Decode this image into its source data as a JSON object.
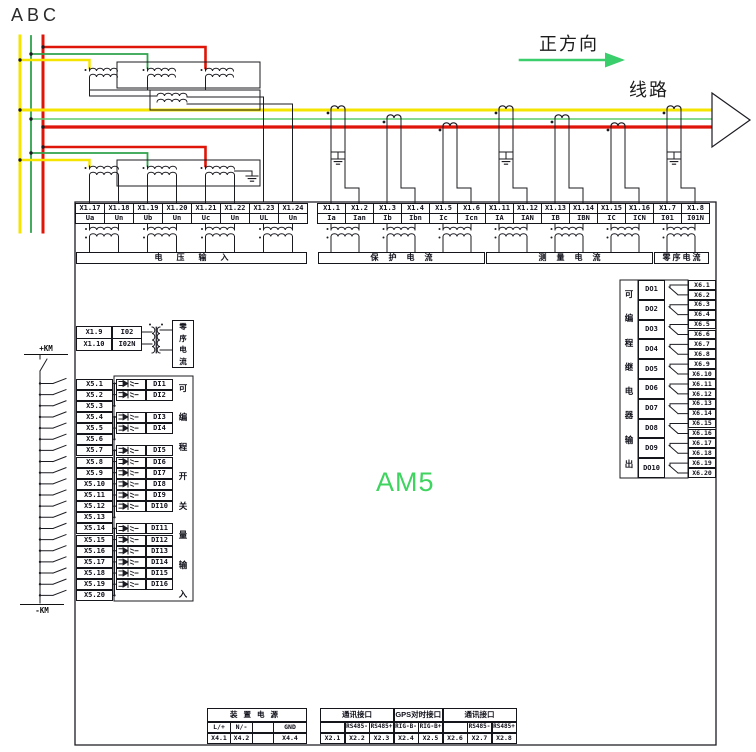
{
  "phases": [
    "A",
    "B",
    "C"
  ],
  "direction_label": "正方向",
  "line_label": "线路",
  "device_label": "AM5",
  "km_plus": "+KM",
  "km_minus": "-KM",
  "terminal_groups": [
    {
      "label": "电压输入",
      "terminals": [
        {
          "num": "X1.17",
          "name": "Ua"
        },
        {
          "num": "X1.18",
          "name": "Un"
        },
        {
          "num": "X1.19",
          "name": "Ub"
        },
        {
          "num": "X1.20",
          "name": "Un"
        },
        {
          "num": "X1.21",
          "name": "Uc"
        },
        {
          "num": "X1.22",
          "name": "Un"
        },
        {
          "num": "X1.23",
          "name": "UL"
        },
        {
          "num": "X1.24",
          "name": "Un"
        }
      ]
    },
    {
      "label": "保护电流",
      "terminals": [
        {
          "num": "X1.1",
          "name": "Ia"
        },
        {
          "num": "X1.2",
          "name": "Ian"
        },
        {
          "num": "X1.3",
          "name": "Ib"
        },
        {
          "num": "X1.4",
          "name": "Ibn"
        },
        {
          "num": "X1.5",
          "name": "Ic"
        },
        {
          "num": "X1.6",
          "name": "Icn"
        }
      ]
    },
    {
      "label": "测量电流",
      "terminals": [
        {
          "num": "X1.11",
          "name": "IA"
        },
        {
          "num": "X1.12",
          "name": "IAN"
        },
        {
          "num": "X1.13",
          "name": "IB"
        },
        {
          "num": "X1.14",
          "name": "IBN"
        },
        {
          "num": "X1.15",
          "name": "IC"
        },
        {
          "num": "X1.16",
          "name": "ICN"
        }
      ]
    },
    {
      "label": "零序电流",
      "terminals": [
        {
          "num": "X1.7",
          "name": "I01"
        },
        {
          "num": "X1.8",
          "name": "I01N"
        }
      ]
    }
  ],
  "zero_seq_aux": {
    "label": "零序电流",
    "terminals": [
      {
        "num": "X1.9",
        "name": "I02"
      },
      {
        "num": "X1.10",
        "name": "I02N"
      }
    ]
  },
  "di_block": {
    "label": "可编程开关量输入",
    "rows": [
      {
        "terminal": "X5.1",
        "di": "DI1"
      },
      {
        "terminal": "X5.2",
        "di": "DI2"
      },
      {
        "terminal": "X5.3",
        "di": null
      },
      {
        "terminal": "X5.4",
        "di": "DI3"
      },
      {
        "terminal": "X5.5",
        "di": "DI4"
      },
      {
        "terminal": "X5.6",
        "di": null
      },
      {
        "terminal": "X5.7",
        "di": "DI5"
      },
      {
        "terminal": "X5.8",
        "di": "DI6"
      },
      {
        "terminal": "X5.9",
        "di": "DI7"
      },
      {
        "terminal": "X5.10",
        "di": "DI8"
      },
      {
        "terminal": "X5.11",
        "di": "DI9"
      },
      {
        "terminal": "X5.12",
        "di": "DI10"
      },
      {
        "terminal": "X5.13",
        "di": null
      },
      {
        "terminal": "X5.14",
        "di": "DI11"
      },
      {
        "terminal": "X5.15",
        "di": "DI12"
      },
      {
        "terminal": "X5.16",
        "di": "DI13"
      },
      {
        "terminal": "X5.17",
        "di": "DI14"
      },
      {
        "terminal": "X5.18",
        "di": "DI15"
      },
      {
        "terminal": "X5.19",
        "di": "DI16"
      },
      {
        "terminal": "X5.20",
        "di": null
      }
    ]
  },
  "do_block": {
    "label": "可编程继电器输出",
    "rows": [
      {
        "do": "DO1",
        "terminals": [
          "X6.1",
          "X6.2"
        ]
      },
      {
        "do": "DO2",
        "terminals": [
          "X6.3",
          "X6.4"
        ]
      },
      {
        "do": "DO3",
        "terminals": [
          "X6.5",
          "X6.6"
        ]
      },
      {
        "do": "DO4",
        "terminals": [
          "X6.7",
          "X6.8"
        ]
      },
      {
        "do": "DO5",
        "terminals": [
          "X6.9",
          "X6.10"
        ]
      },
      {
        "do": "DO6",
        "terminals": [
          "X6.11",
          "X6.12"
        ]
      },
      {
        "do": "DO7",
        "terminals": [
          "X6.13",
          "X6.14"
        ]
      },
      {
        "do": "DO8",
        "terminals": [
          "X6.15",
          "X6.16"
        ]
      },
      {
        "do": "DO9",
        "terminals": [
          "X6.17",
          "X6.18"
        ]
      },
      {
        "do": "DO10",
        "terminals": [
          "X6.19",
          "X6.20"
        ]
      }
    ]
  },
  "power_table": {
    "title": "装置电源",
    "columns": [
      {
        "label": "L/+",
        "terminal": "X4.1"
      },
      {
        "label": "N/-",
        "terminal": "X4.2"
      },
      {
        "label": "",
        "terminal": ""
      },
      {
        "label": "GND",
        "terminal": "X4.4"
      }
    ]
  },
  "comm_table": {
    "sections": [
      {
        "title": "通讯接口",
        "columns": [
          {
            "label": "",
            "terminal": "X2.1"
          },
          {
            "label": "RS485-",
            "terminal": "X2.2"
          },
          {
            "label": "RS485+",
            "terminal": "X2.3"
          }
        ]
      },
      {
        "title": "GPS对时接口",
        "columns": [
          {
            "label": "RIG-B-",
            "terminal": "X2.4"
          },
          {
            "label": "RIG-B+",
            "terminal": "X2.5"
          }
        ]
      },
      {
        "title": "通讯接口",
        "columns": [
          {
            "label": "",
            "terminal": "X2.6"
          },
          {
            "label": "RS485-",
            "terminal": "X2.7"
          },
          {
            "label": "RS485+",
            "terminal": "X2.8"
          }
        ]
      }
    ]
  },
  "colors": {
    "phase_a": "#F5E400",
    "phase_b": "#2EA24C",
    "phase_b_bus": "#5BCB6E",
    "phase_c": "#DE1508",
    "direction_arrow": "#3BCE6C",
    "device_label": "#3FD35F",
    "wire": "#1b1b22"
  }
}
